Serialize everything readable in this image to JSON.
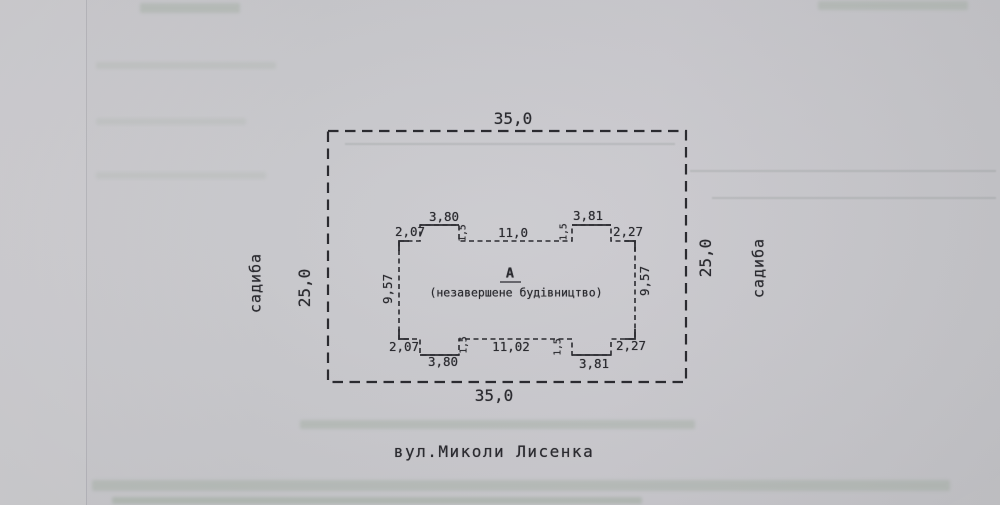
{
  "colors": {
    "ink": "#2b2b30",
    "paper": "#c9c9cd",
    "bleed": "#8fa08d"
  },
  "plot": {
    "width_top": "35,0",
    "width_bottom": "35,0",
    "depth_left": "25,0",
    "depth_right": "25,0",
    "neighbor_left": "садиба",
    "neighbor_right": "садиба",
    "street": "вул.Миколи Лисенка"
  },
  "building": {
    "letter": "А",
    "status_note": "(незавершене будівництво)",
    "side_left": "9,57",
    "side_right": "9,57",
    "top_dims": {
      "offset_left": "2,07",
      "bay_left": "3,80",
      "notch_left": "1,5",
      "center": "11,0",
      "notch_right": "1,5",
      "bay_right": "3,81",
      "offset_right": "2,27"
    },
    "bottom_dims": {
      "offset_left": "2,07",
      "bay_left": "3,80",
      "notch_left": "1,5",
      "center": "11,02",
      "notch_right": "1,5",
      "bay_right": "3,81",
      "offset_right": "2,27"
    }
  }
}
